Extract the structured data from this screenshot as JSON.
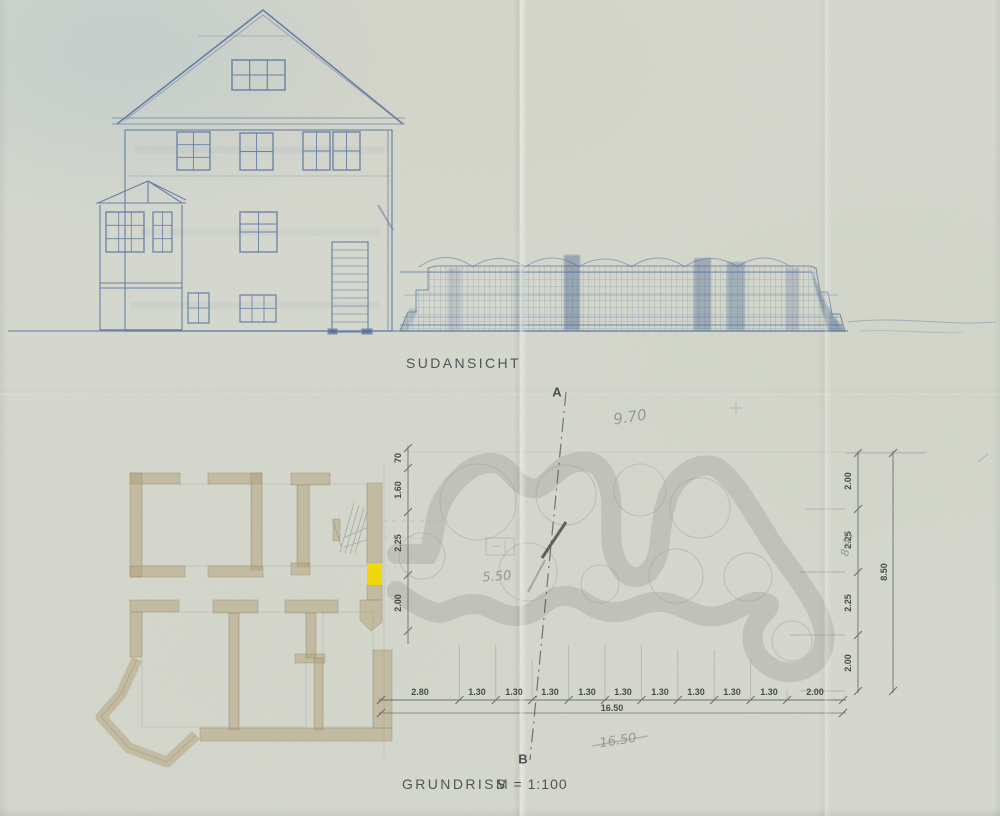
{
  "titles": {
    "elevation": "SUDANSICHT",
    "plan": "GRUNDRISS",
    "plan_scale": "M = 1:100"
  },
  "section_markers": {
    "top": "A",
    "bottom": "B"
  },
  "dimensions": {
    "left_chain": [
      "70",
      "1.60",
      "2.25",
      "2.00"
    ],
    "right_chain": [
      "2.00",
      "2.25",
      "2.25",
      "2.00"
    ],
    "right_total": "8.50",
    "bottom_chain": [
      "2.80",
      "1.30",
      "1.30",
      "1.30",
      "1.30",
      "1.30",
      "1.30",
      "1.30",
      "1.30",
      "1.30",
      "2.00"
    ],
    "bottom_total": "16.50"
  },
  "pencil_notes": {
    "width": "9.70",
    "inner": "5.50",
    "height": "8.40",
    "total_crossed": "16.50"
  },
  "colors": {
    "paper": "#d7dacf",
    "ink_blue": "#54719f",
    "wall_tan": "#b2a078",
    "garden_green": "#5ea583",
    "highlight_yellow": "#f2d800",
    "pencil_gray": "#8f938c"
  }
}
